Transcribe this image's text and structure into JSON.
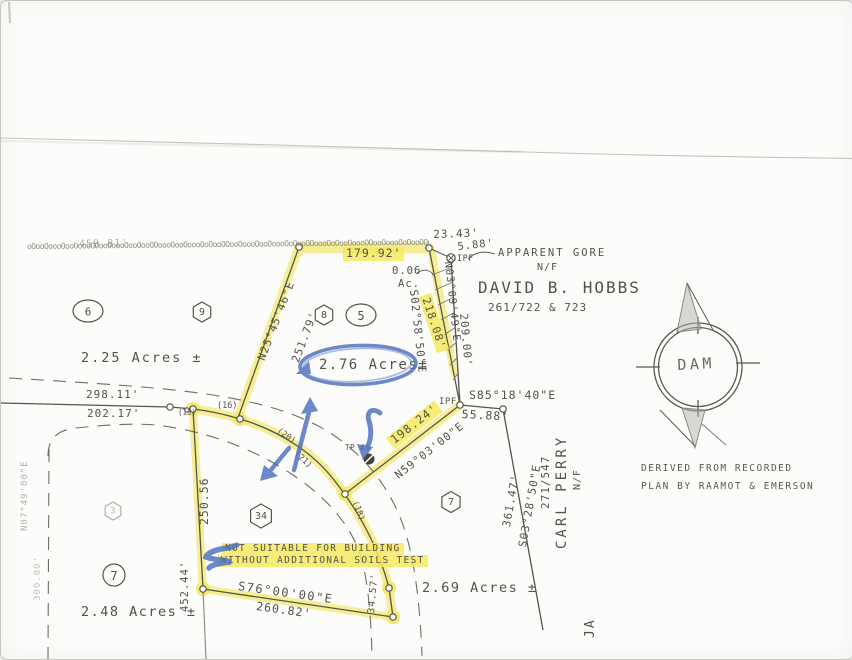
{
  "palette": {
    "ink": "#53514c",
    "highlight": "#f4e96d",
    "marker_blue": "#4d6fbe",
    "paper": "#fcfcfa"
  },
  "wall": {
    "distance": "459.81'",
    "pattern": "oOooOoooOooOoooOOooOoooOooOooOOoooOooOoooOoOooOOooOoooOooOoooOoOooOOoooOoOooOoooOOooOoooOoOooOOoooOo"
  },
  "gore": {
    "label": "APPARENT GORE",
    "dist_top": "23.43'",
    "dist_gap": "5.88'",
    "ipf_top": "IPF",
    "area": "0.06",
    "area_unit": "Ac."
  },
  "neighbors": {
    "hobbs": {
      "nf": "N/F",
      "name": "DAVID B. HOBBS",
      "deed": "261/722 & 723"
    },
    "perry": {
      "nf": "N/F",
      "name": "CARL PERRY",
      "deed": "271/547",
      "line_bearing": "S03°28'50\"E",
      "line_dist": "361.47'"
    },
    "ja_initials": "JA"
  },
  "lot5": {
    "marker_hex": "8",
    "marker_oval": "5",
    "acreage": "2.76 Acres±",
    "north_dist": "179.92'",
    "west_bearing": "N25°45'46\"E",
    "west_dist": "251.79'",
    "east_bearing_inner": "S02°58'50\"E",
    "east_dist_inner": "218.08'",
    "east_bearing_outer": "N03°09'49\"E",
    "east_dist_outer": "209.00'",
    "south_bearing": "N59°03'00\"E",
    "south_dist": "198.24'",
    "ipf_mid": "IPF",
    "hobbs_tie_bearing": "S85°18'40\"E",
    "hobbs_tie_dist": "55.88'"
  },
  "lot6": {
    "marker_oval": "6",
    "marker_hex": "9",
    "acreage": "2.25 Acres ±",
    "road_dist_upper": "298.11'",
    "road_dist_lower": "202.17'"
  },
  "lot34": {
    "marker_hex": "34",
    "west_dist": "250.56",
    "west_dist_lower": "452.44'",
    "south_bearing": "S76°00'00\"E",
    "south_dist": "260.82'",
    "east_dist": "34.57'",
    "note_line1": "NOT SUITABLE FOR BUILDING",
    "note_line2": "WITHOUT ADDITIONAL SOILS TEST"
  },
  "lot7_east": {
    "marker_hex": "7",
    "acreage": "2.69 Acres ±"
  },
  "lot7_west": {
    "marker_circle": "7",
    "marker_hex_faint": "3",
    "acreage": "2.48 Acres ±",
    "road_bearing": "N07°49'00\"E",
    "road_dist": "300.00'"
  },
  "road": {
    "curve_13": "(13)",
    "curve_16": "(16)",
    "curve_18": "(18)",
    "curve_20": "(20)",
    "curve_21": "(21)"
  },
  "test_pit": {
    "label": "TP #5"
  },
  "compass": {
    "label": "DAM"
  },
  "credits": {
    "line1": "DERIVED FROM RECORDED",
    "line2": "PLAN BY RAAMOT & EMERSON"
  }
}
